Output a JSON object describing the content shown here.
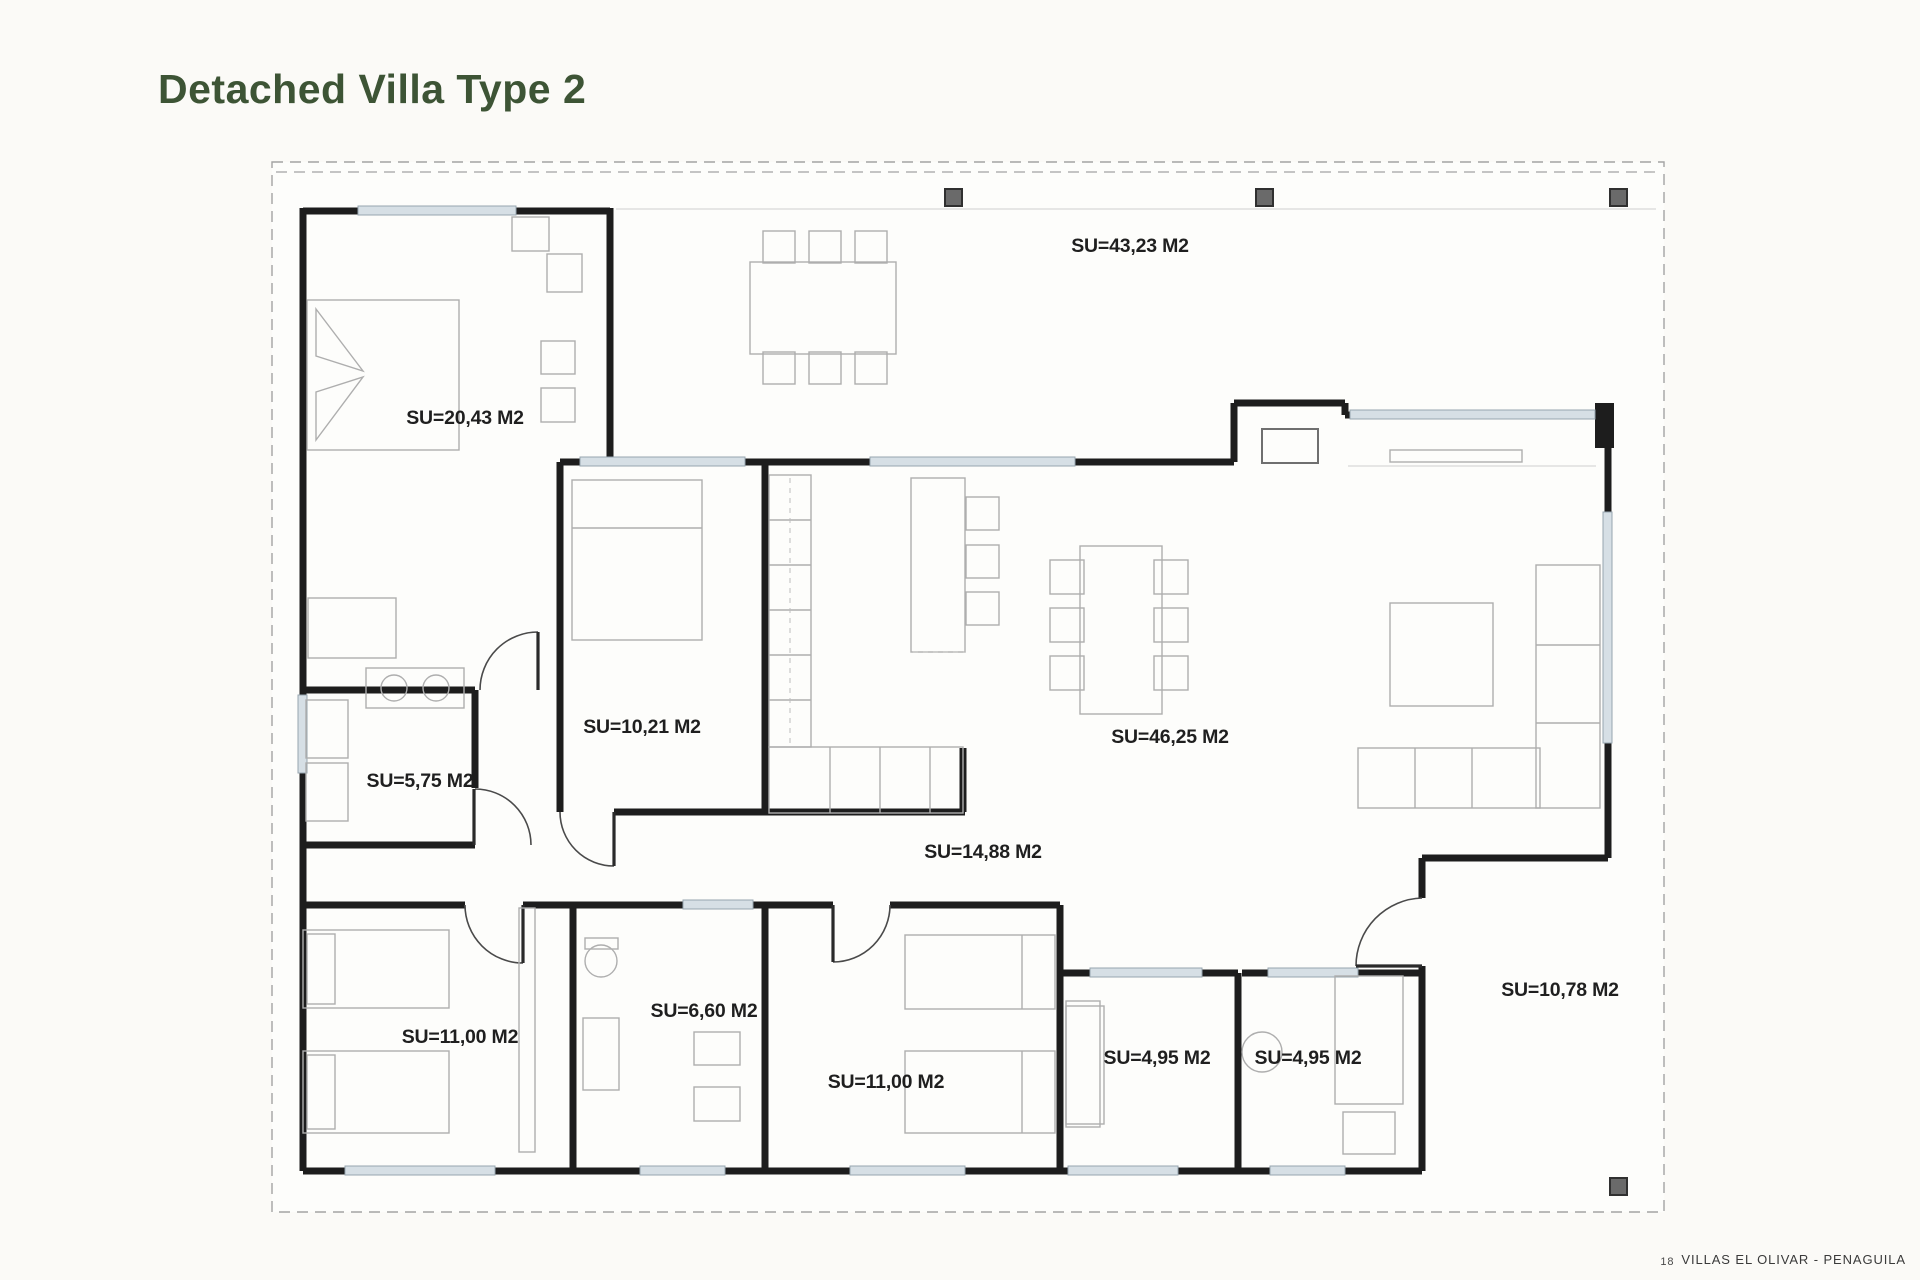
{
  "title": "Detached Villa Type 2",
  "footer": {
    "page_number": "18",
    "project": "VILLAS EL OLIVAR - PENAGUILA"
  },
  "rooms": [
    {
      "name": "terrace",
      "label": "SU=43,23 M2"
    },
    {
      "name": "master-bedroom",
      "label": "SU=20,43 M2"
    },
    {
      "name": "bedroom-2",
      "label": "SU=10,21 M2"
    },
    {
      "name": "utility-room",
      "label": "SU=5,75 M2"
    },
    {
      "name": "living-dining",
      "label": "SU=46,25 M2"
    },
    {
      "name": "hallway-kitchen",
      "label": "SU=14,88 M2"
    },
    {
      "name": "bedroom-3",
      "label": "SU=11,00 M2"
    },
    {
      "name": "bathroom-1",
      "label": "SU=6,60 M2"
    },
    {
      "name": "bedroom-4",
      "label": "SU=11,00 M2"
    },
    {
      "name": "bathroom-2",
      "label": "SU=4,95 M2"
    },
    {
      "name": "bathroom-3",
      "label": "SU=4,95 M2"
    },
    {
      "name": "porch",
      "label": "SU=10,78 M2"
    }
  ],
  "colors": {
    "title": "#3d5435",
    "walls": "#1d1d1d",
    "windows": "#d6dfe5",
    "plot_border": "#a3a3a3",
    "background": "#fbfaf7",
    "footer_text": "#3a3a3a"
  }
}
